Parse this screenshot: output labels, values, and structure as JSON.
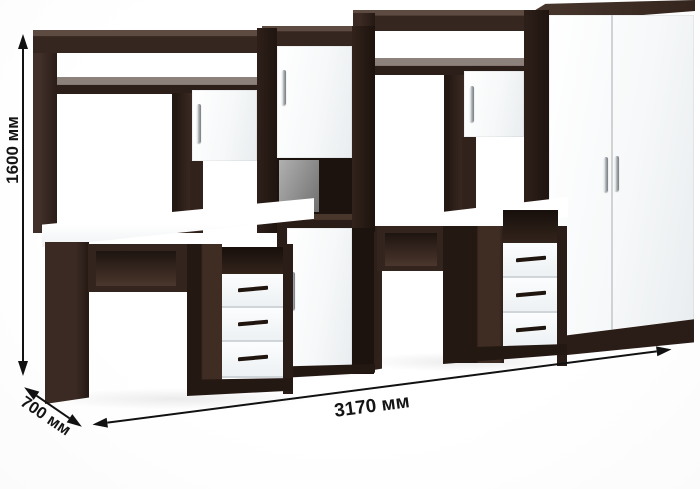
{
  "dimensions": {
    "height_label": "1600 мм",
    "depth_label": "700 мм",
    "width_label": "3170 мм"
  },
  "icons": {
    "height_arrow": "double-headed-vertical-arrow",
    "depth_arrow": "double-headed-diagonal-arrow",
    "width_arrow": "double-headed-horizontal-arrow"
  },
  "colors": {
    "background": "#ffffff",
    "wenge": "#35261f",
    "wenge_dark": "#2a1c17",
    "wenge_deep": "#1d130e",
    "wood_top": "#5d4a40",
    "shelf_top": "#8d817b",
    "panel_white": "#ffffff",
    "panel_shade": "#e9edef",
    "chrome": "#a9aeb2",
    "handle_dark": "#20150f",
    "annotation": "#111111"
  }
}
